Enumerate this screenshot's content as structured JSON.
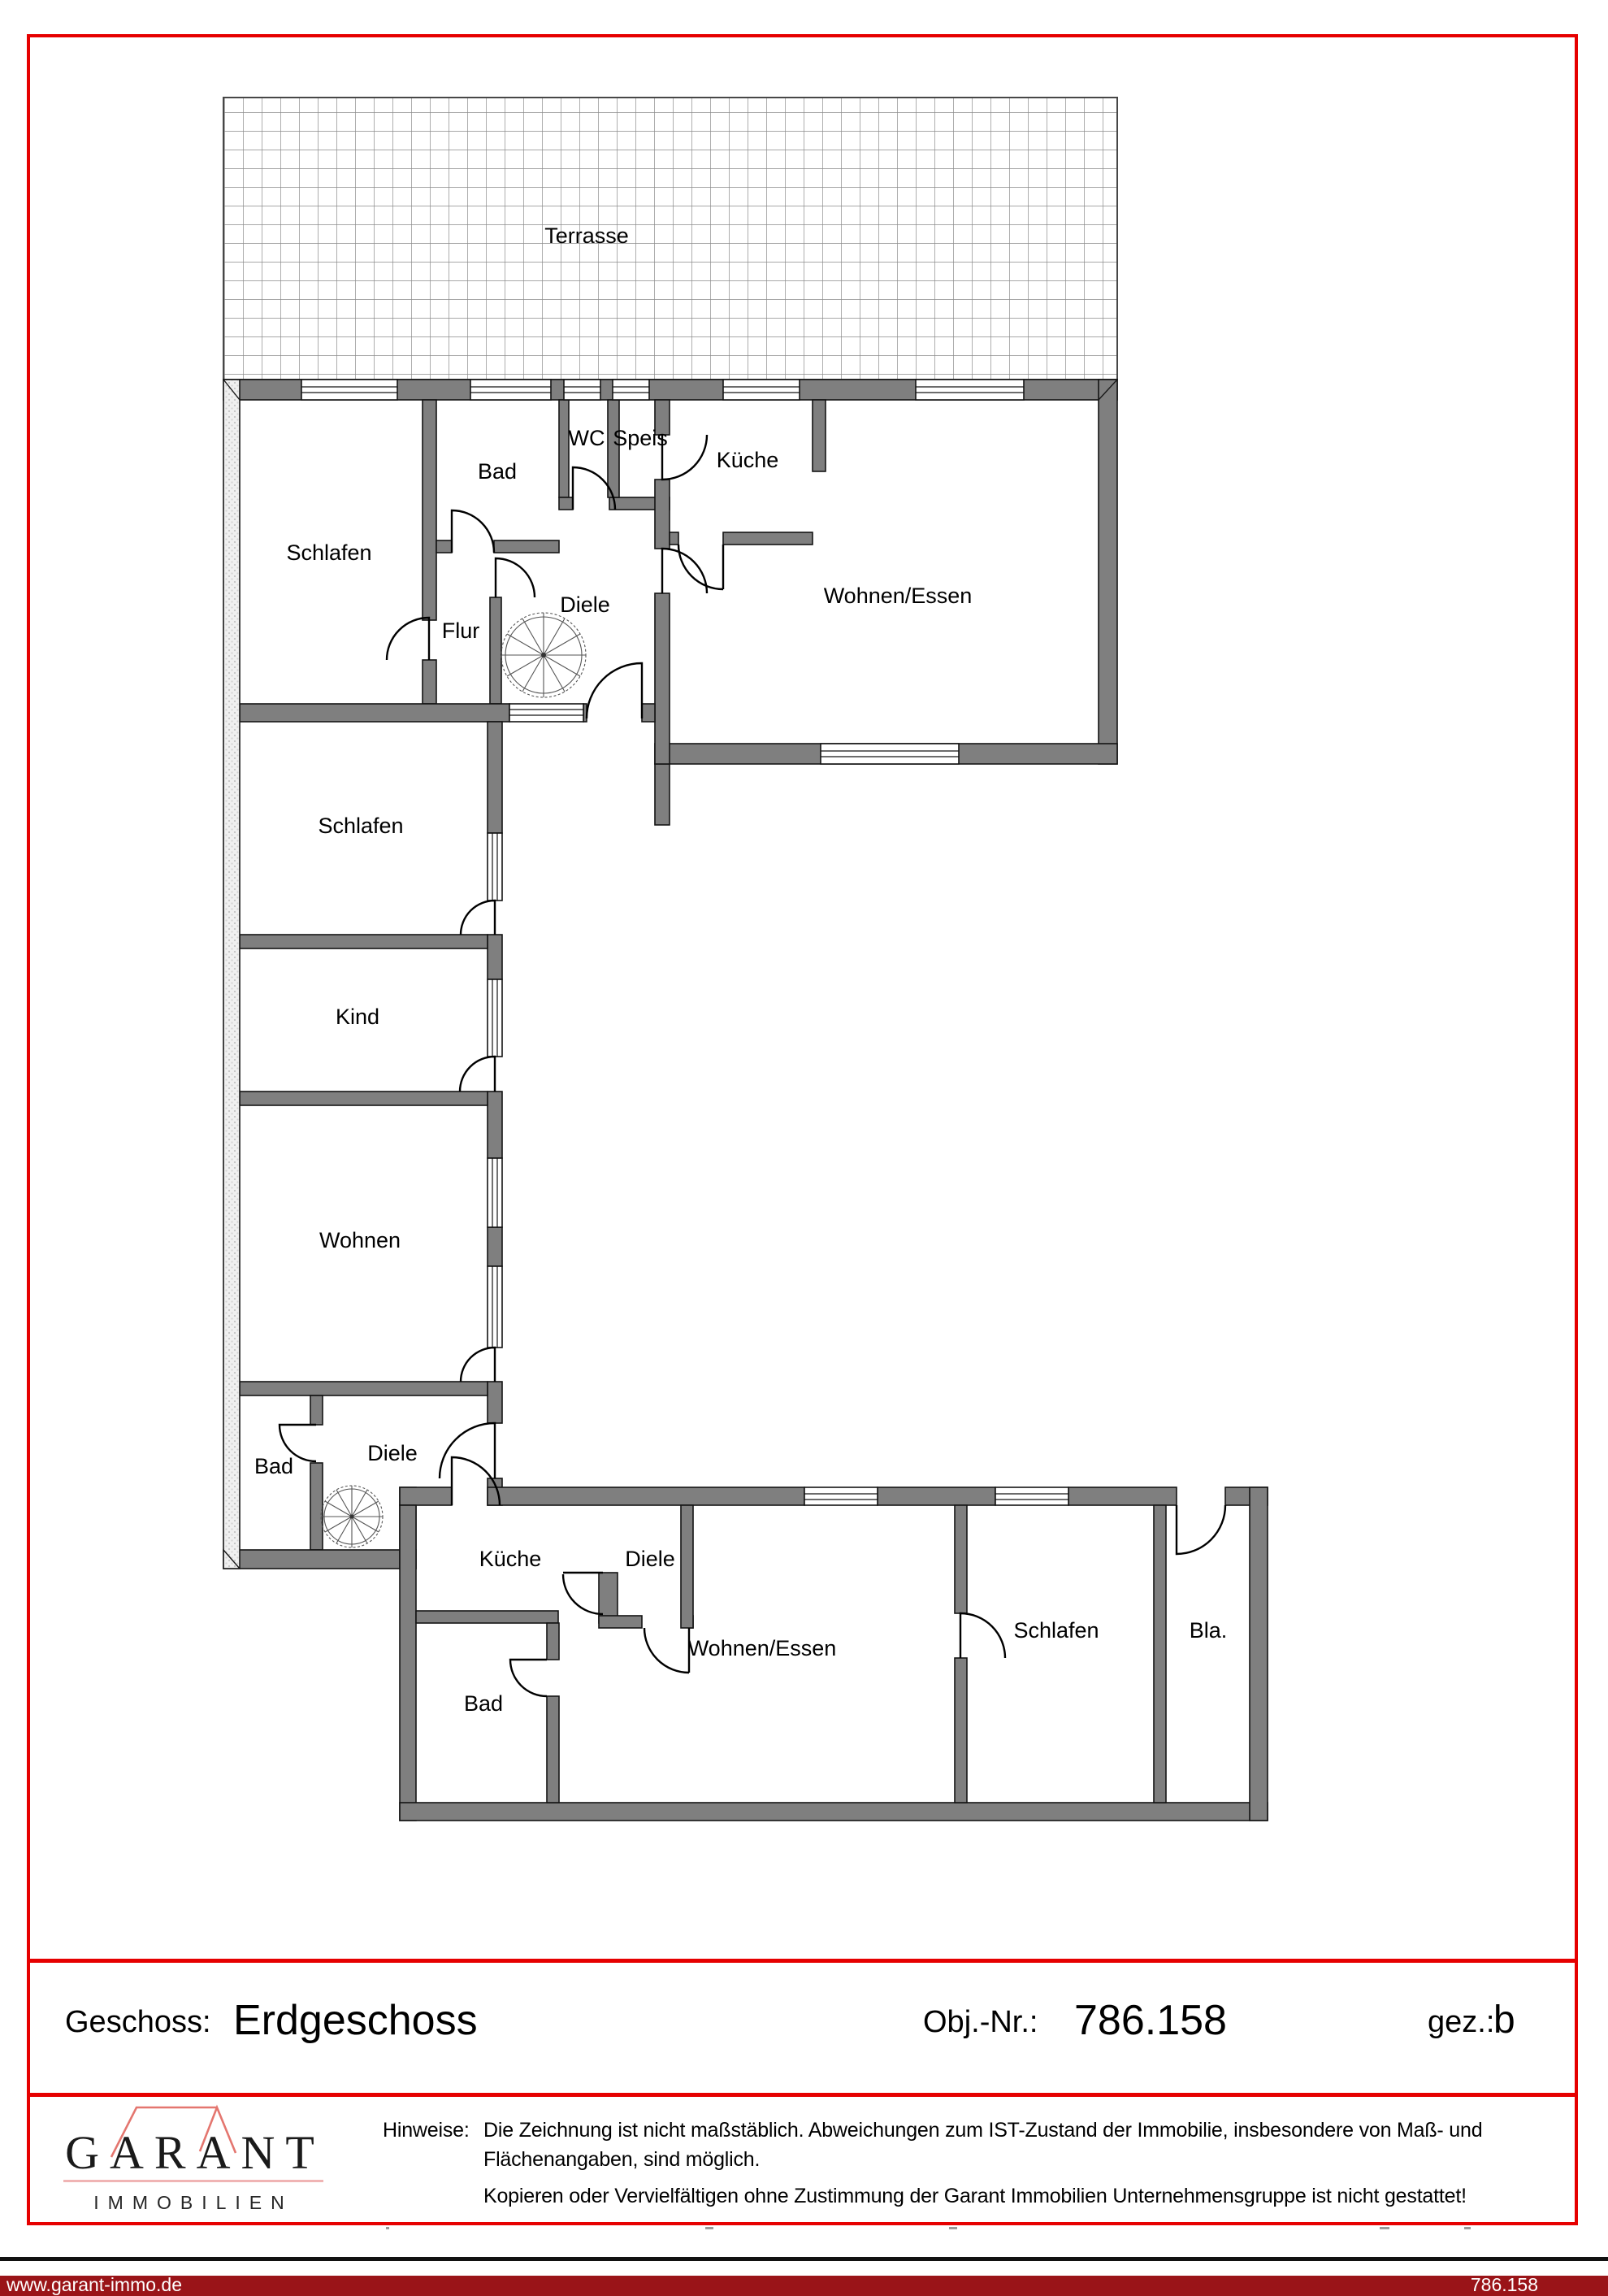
{
  "plan": {
    "terrace_label": "Terrasse",
    "upper": {
      "schlafen1": "Schlafen",
      "bad": "Bad",
      "wc": "WC",
      "speis": "Speis",
      "kueche": "Küche",
      "diele": "Diele",
      "flur": "Flur",
      "wohnen_essen": "Wohnen/Essen"
    },
    "wing": {
      "schlafen2": "Schlafen",
      "kind": "Kind",
      "wohnen": "Wohnen",
      "bad": "Bad",
      "diele": "Diele"
    },
    "lower": {
      "kueche": "Küche",
      "diele": "Diele",
      "bad": "Bad",
      "wohnen_essen": "Wohnen/Essen",
      "schlafen": "Schlafen",
      "balkon": "Bla."
    }
  },
  "footer": {
    "geschoss_label": "Geschoss:",
    "geschoss_value": "Erdgeschoss",
    "obj_label": "Obj.-Nr.:",
    "obj_value": "786.158",
    "gez_label": "gez.:",
    "gez_value": "b"
  },
  "logo": {
    "name": "GARANT",
    "subtitle": "IMMOBILIEN"
  },
  "notes": {
    "label": "Hinweise:",
    "line1": "Die Zeichnung ist nicht maßstäblich. Abweichungen zum IST-Zustand der Immobilie, insbesondere von Maß- und",
    "line2": "Flächenangaben, sind möglich.",
    "line3": "Kopieren oder Vervielfältigen ohne Zustimmung der Garant Immobilien Unternehmensgruppe ist nicht gestattet!"
  },
  "bottom_bar": {
    "website": "www.garant-immo.de",
    "object_number": "786.158"
  },
  "colors": {
    "frame_red": "#e60000",
    "bar_red": "#9a1418",
    "logo_roof_red": "#e4766f",
    "logo_underline_pink": "#f0b4b4",
    "wall_gray": "#7f7f7f"
  }
}
